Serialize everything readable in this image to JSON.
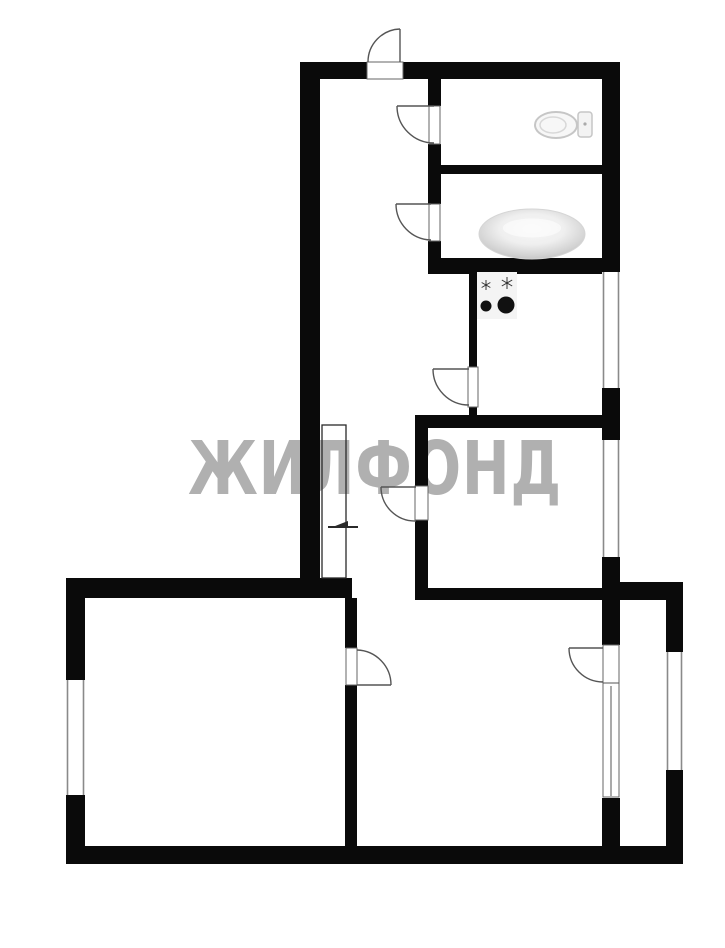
{
  "canvas": {
    "width": 725,
    "height": 948,
    "background": "#ffffff"
  },
  "watermark": {
    "text": "ЖИЛФОНД",
    "color": "#b0b0b0"
  },
  "colors": {
    "wall": "#0a0a0a",
    "door_line": "#555555",
    "jamb_stroke": "#666666",
    "window_line": "#8a8a8a",
    "closet_line": "#2a2a2a",
    "fixture_outline": "#c6c6c6",
    "fixture_fill": "#f7f7f7",
    "burner": "#111111",
    "spark": "#333333"
  },
  "plan": {
    "walls": [
      {
        "name": "top-wall-left",
        "x": 300,
        "y": 62,
        "w": 67,
        "h": 17
      },
      {
        "name": "top-wall-right",
        "x": 403,
        "y": 62,
        "w": 217,
        "h": 17
      },
      {
        "name": "left-wall-upper",
        "x": 300,
        "y": 62,
        "w": 20,
        "h": 536
      },
      {
        "name": "right-wall-top",
        "x": 602,
        "y": 62,
        "w": 18,
        "h": 210
      },
      {
        "name": "right-wall-mid",
        "x": 602,
        "y": 388,
        "w": 18,
        "h": 52
      },
      {
        "name": "right-wall-lower",
        "x": 602,
        "y": 557,
        "w": 18,
        "h": 88
      },
      {
        "name": "right-wall-bottom",
        "x": 602,
        "y": 798,
        "w": 18,
        "h": 48
      },
      {
        "name": "wc-left-wall-a",
        "x": 428,
        "y": 79,
        "w": 13,
        "h": 27
      },
      {
        "name": "wc-left-wall-b",
        "x": 428,
        "y": 144,
        "w": 13,
        "h": 60
      },
      {
        "name": "wc-left-wall-c",
        "x": 428,
        "y": 241,
        "w": 13,
        "h": 31
      },
      {
        "name": "wc-bath-divider-wall",
        "x": 428,
        "y": 165,
        "w": 174,
        "h": 9
      },
      {
        "name": "bath-bottom-wall",
        "x": 428,
        "y": 258,
        "w": 192,
        "h": 16
      },
      {
        "name": "kitchen-left-wall-a",
        "x": 469,
        "y": 265,
        "w": 8,
        "h": 102
      },
      {
        "name": "kitchen-left-wall-b",
        "x": 469,
        "y": 407,
        "w": 8,
        "h": 21
      },
      {
        "name": "kitchen-bottom-wall",
        "x": 415,
        "y": 415,
        "w": 205,
        "h": 13
      },
      {
        "name": "bedroom-left-wall-a",
        "x": 415,
        "y": 428,
        "w": 13,
        "h": 58
      },
      {
        "name": "bedroom-left-wall-b",
        "x": 415,
        "y": 520,
        "w": 13,
        "h": 80
      },
      {
        "name": "bedroom-bottom-wall",
        "x": 415,
        "y": 588,
        "w": 205,
        "h": 12
      },
      {
        "name": "room2-top-wall",
        "x": 66,
        "y": 578,
        "w": 286,
        "h": 20
      },
      {
        "name": "left-wall-lower-a",
        "x": 66,
        "y": 578,
        "w": 19,
        "h": 102
      },
      {
        "name": "left-wall-lower-b",
        "x": 66,
        "y": 795,
        "w": 19,
        "h": 69
      },
      {
        "name": "bottom-wall",
        "x": 66,
        "y": 846,
        "w": 617,
        "h": 18
      },
      {
        "name": "room2-right-wall-a",
        "x": 345,
        "y": 598,
        "w": 12,
        "h": 50
      },
      {
        "name": "room2-right-wall-b",
        "x": 345,
        "y": 685,
        "w": 12,
        "h": 161
      },
      {
        "name": "balcony-top-wall",
        "x": 620,
        "y": 582,
        "w": 63,
        "h": 18
      },
      {
        "name": "balcony-right-wall-a",
        "x": 666,
        "y": 582,
        "w": 17,
        "h": 70
      },
      {
        "name": "balcony-right-wall-b",
        "x": 666,
        "y": 770,
        "w": 17,
        "h": 94
      }
    ],
    "windows": [
      {
        "name": "kitchen-window",
        "x": 602,
        "y": 272,
        "w": 18,
        "h": 116
      },
      {
        "name": "bedroom-window",
        "x": 602,
        "y": 440,
        "w": 18,
        "h": 117
      },
      {
        "name": "room2-window",
        "x": 66,
        "y": 680,
        "w": 19,
        "h": 115
      },
      {
        "name": "balcony-window",
        "x": 666,
        "y": 652,
        "w": 17,
        "h": 118
      }
    ],
    "door_jambs": [
      {
        "name": "entry-door-sill",
        "x": 367,
        "y": 62,
        "w": 36,
        "h": 17
      },
      {
        "name": "toilet-door-jamb",
        "x": 429,
        "y": 106,
        "w": 11,
        "h": 38
      },
      {
        "name": "bathroom-door-jamb",
        "x": 429,
        "y": 204,
        "w": 11,
        "h": 37
      },
      {
        "name": "kitchen-door-jamb",
        "x": 468,
        "y": 367,
        "w": 10,
        "h": 40
      },
      {
        "name": "bedroom-door-jamb",
        "x": 415,
        "y": 486,
        "w": 13,
        "h": 34
      },
      {
        "name": "room2-door-jamb",
        "x": 346,
        "y": 648,
        "w": 11,
        "h": 37
      },
      {
        "name": "balcony-door-window-strip",
        "x": 603,
        "y": 645,
        "w": 16,
        "h": 152
      }
    ],
    "thin_lines": [
      {
        "name": "balcony-strip-divider",
        "d": "M603,683 L619,683"
      },
      {
        "name": "balcony-window-mid-line",
        "d": "M611,686 L611,796"
      }
    ],
    "door_swings": [
      {
        "name": "entry-door-swing",
        "leaf": "M400,62 L400,29",
        "arc": "M400,29 A33,33 0 0 0 368,62"
      },
      {
        "name": "toilet-door-swing",
        "leaf": "M434,106 L397,106",
        "arc": "M397,106 A37,37 0 0 0 434,143"
      },
      {
        "name": "bathroom-door-swing",
        "leaf": "M431,204 L396,204",
        "arc": "M396,204 A36,36 0 0 0 431,240"
      },
      {
        "name": "kitchen-door-swing",
        "leaf": "M469,369 L433,369",
        "arc": "M433,369 A36,36 0 0 0 469,405"
      },
      {
        "name": "bedroom-door-swing",
        "leaf": "M416,487 L381,487",
        "arc": "M381,487 A34,34 0 0 0 416,521"
      },
      {
        "name": "room2-door-swing",
        "leaf": "M357,685 L391,685",
        "arc": "M391,685 A35,35 0 0 0 357,650"
      },
      {
        "name": "balcony-door-swing",
        "leaf": "M603,648 L569,648",
        "arc": "M569,648 A34,34 0 0 0 603,682"
      }
    ],
    "closet": {
      "name": "built-in-closet",
      "x": 322,
      "y": 425,
      "w": 24,
      "h": 153,
      "mark_line": "M328,527 L358,527",
      "mark_triangle": "330,528 348,521 348,528"
    },
    "fixtures": {
      "toilet": {
        "name": "toilet-icon",
        "bowl": {
          "cx": 556,
          "cy": 125,
          "rx": 21,
          "ry": 13
        },
        "inner": {
          "cx": 553,
          "cy": 125,
          "rx": 13,
          "ry": 8
        },
        "tank": {
          "x": 578,
          "y": 112,
          "w": 14,
          "h": 25
        },
        "button": {
          "cx": 585,
          "cy": 124,
          "r": 1.6
        }
      },
      "bathtub": {
        "name": "bathtub-icon",
        "cx": 532,
        "cy": 234,
        "rx": 53,
        "ry": 25
      },
      "stove": {
        "name": "stove-icon",
        "panel": {
          "x": 477,
          "y": 272,
          "w": 40,
          "h": 47,
          "fill": "#f4f4f4"
        },
        "burners": [
          {
            "cx": 486,
            "cy": 306,
            "r": 5.5
          },
          {
            "cx": 506,
            "cy": 305,
            "r": 8.5
          }
        ],
        "sparks": [
          {
            "cx": 486,
            "cy": 285,
            "r": 5
          },
          {
            "cx": 507,
            "cy": 283,
            "r": 6
          }
        ]
      }
    }
  }
}
